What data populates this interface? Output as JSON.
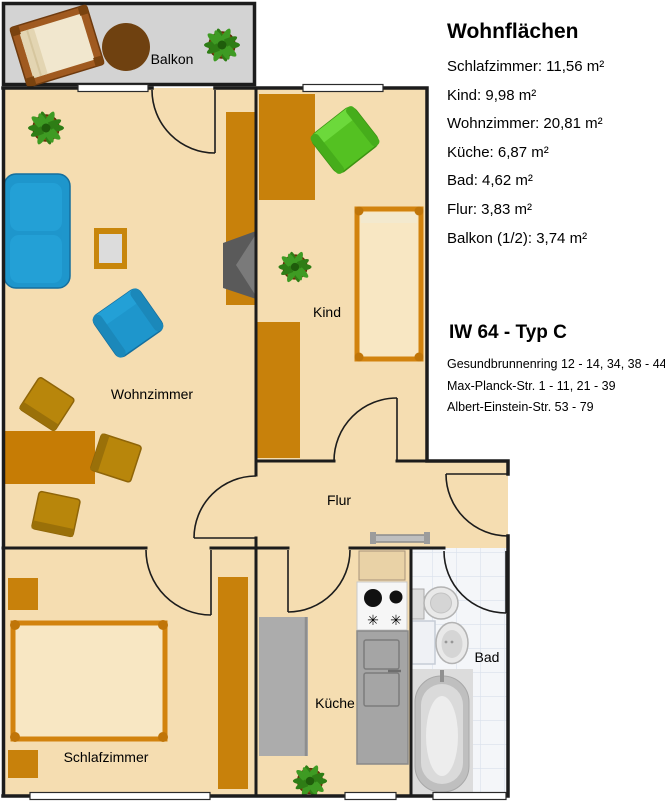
{
  "legend": {
    "title": "Wohnflächen",
    "items": [
      {
        "room": "Schlafzimmer",
        "area": "11,56 m²",
        "text": "Schlafzimmer: 11,56 m²"
      },
      {
        "room": "Kind",
        "area": "9,98 m²",
        "text": "Kind: 9,98 m²"
      },
      {
        "room": "Wohnzimmer",
        "area": "20,81 m²",
        "text": "Wohnzimmer: 20,81 m²"
      },
      {
        "room": "Küche",
        "area": "6,87 m²",
        "text": "Küche: 6,87 m²"
      },
      {
        "room": "Bad",
        "area": "4,62 m²",
        "text": "Bad: 4,62 m²"
      },
      {
        "room": "Flur",
        "area": "3,83 m²",
        "text": "Flur: 3,83 m²"
      },
      {
        "room": "Balkon (1/2)",
        "area": "3,74 m²",
        "text": "Balkon (1/2): 3,74 m²"
      }
    ]
  },
  "building": {
    "title": "IW 64 - Typ C",
    "addresses": [
      "Gesundbrunnenring 12 - 14, 34, 38 - 44",
      "Max-Planck-Str. 1 - 11, 21 - 39",
      "Albert-Einstein-Str. 53 - 79"
    ]
  },
  "floorplan": {
    "rooms": {
      "balkon": "Balkon",
      "wohnzimmer": "Wohnzimmer",
      "kind": "Kind",
      "flur": "Flur",
      "schlafzimmer": "Schlafzimmer",
      "kueche": "Küche",
      "bad": "Bad"
    }
  },
  "icons": {
    "stove_burner": "✳"
  },
  "colors": {
    "floor": "#F5DDB1",
    "balcony_floor": "#D3D3D3",
    "wall": "#1C1C1C",
    "furniture_orange": "#C8810B",
    "bed_frame": "#D2830E",
    "mattress": "#F8E7C3",
    "sofa_blue": "#1E96CC",
    "armchair_green": "#54C122",
    "counter_gray": "#ACACAC",
    "bath_tile": "#F4F6F9"
  }
}
